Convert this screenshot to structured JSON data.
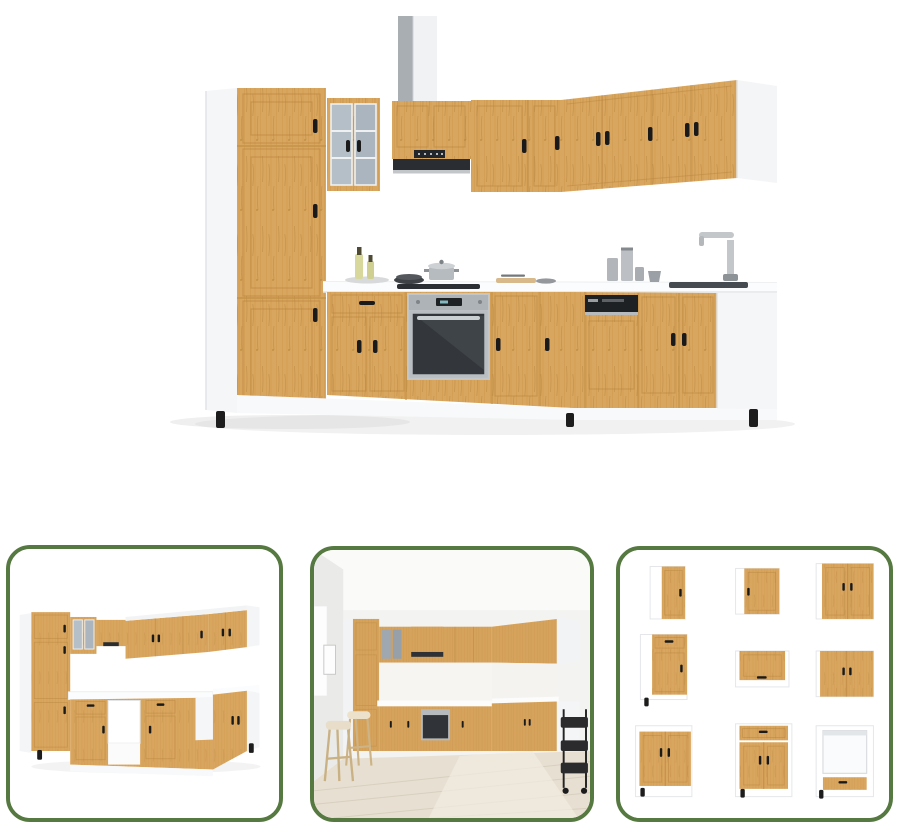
{
  "page": {
    "background": "#ffffff"
  },
  "palette": {
    "wood": "#d9a65f",
    "wood_grain": "#b5813a",
    "carcass_white": "#f4f5f7",
    "appliance_dark": "#26282b",
    "steel": "#b9bec2",
    "glass_pane": "#b4bfc8",
    "thumb_border_green": "#567941",
    "room_floor": "#e7dfd1",
    "room_wall": "#f3f3f1"
  },
  "gallery": {
    "main_image": {
      "name": "main-product-image",
      "alt": "L-shaped kitchen cabinet set in oak and white with built-in oven, extractor hood, dishwasher and sink"
    },
    "thumbnails": [
      {
        "name": "thumbnail-back-view",
        "alt": "Kitchen cabinet set seen from the opposite side on white background"
      },
      {
        "name": "thumbnail-room-scene",
        "alt": "Kitchen cabinet set installed in a room with bar stools and serving cart"
      },
      {
        "name": "thumbnail-modules-grid",
        "alt": "Nine individual cabinet modules of the set",
        "module_count": 9
      }
    ]
  }
}
